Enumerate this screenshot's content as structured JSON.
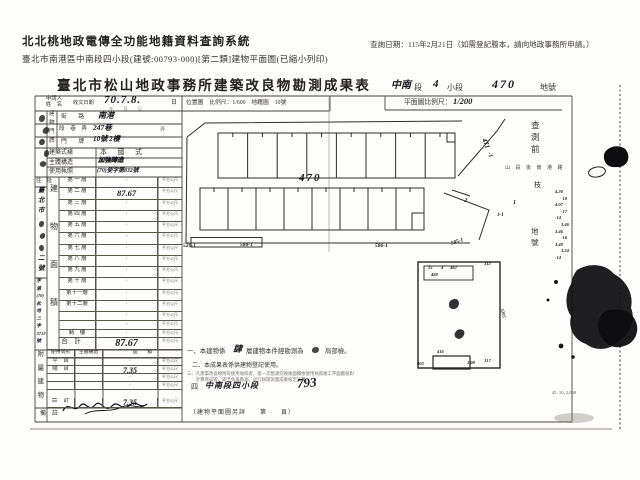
{
  "header": {
    "system_title": "北北桃地政電傳全功能地籍資料查詢系統",
    "doc_subtitle": "臺北市南港區中南段四小段(建號:00793-000)[第二類]建物平面圖(已縮小列印)",
    "query_date": "查詢日期：115年2月21日（如需登記謄本，請向地政事務所申請。）"
  },
  "form": {
    "title": "臺北市松山地政事務所建築改良物勘測成果表",
    "lot_line": [
      {
        "t": "中南",
        "hw": 1,
        "x": 391,
        "y": 81,
        "s": 10
      },
      {
        "t": "段",
        "hw": 0,
        "x": 414,
        "y": 84,
        "s": 8
      },
      {
        "t": "4",
        "hw": 1,
        "x": 433,
        "y": 79,
        "s": 11
      },
      {
        "t": "小段",
        "hw": 0,
        "x": 447,
        "y": 84,
        "s": 8
      },
      {
        "t": "470",
        "hw": 1,
        "x": 492,
        "y": 78,
        "s": 12,
        "ls": 2
      },
      {
        "t": "地號",
        "hw": 0,
        "x": 540,
        "y": 84,
        "s": 8
      }
    ],
    "row1": {
      "applicant_label": "申請人\n姓　名",
      "receipt_label": "收文日期",
      "receipt_value": "70.7.8.",
      "receipt_units": "年　月　日",
      "day_suffix": "日",
      "location_scale": "位置圖　比例尺：1/600　地籍圖　10號",
      "plan_scale_label": "平面圖比例尺：",
      "plan_scale_value": "1/200"
    },
    "premises": {
      "door_col": "建物門牌",
      "street_label": "街　　路",
      "street_value": "南港",
      "lane_label": "段　巷　弄",
      "lane_value": "247巷",
      "lane_suffix": "弄",
      "plate_label": "門　　牌",
      "plate_value": "10號 2樓",
      "style_label": "建築式樣",
      "style_value": "本　國　式",
      "structure_label": "主體構造",
      "structure_value": "加強磚造",
      "license_label": "使用執照",
      "license_value": "(70)使字第832號"
    },
    "left_strip": {
      "address_label": "住　址",
      "address_top": "臺北市",
      "address_bottom": "二號",
      "file_tokens": [
        "字",
        "第",
        "(70)",
        "松",
        "地",
        "二",
        "字",
        "3712",
        "號"
      ],
      "area_col": "建物面積",
      "attach_col": "附屬建物",
      "note_label": "備　註"
    },
    "floors": {
      "rows": [
        {
          "label": "第 一 層",
          "value": "·"
        },
        {
          "label": "第 二 層",
          "value": "87.67",
          "hw": 1
        },
        {
          "label": "第 三 層",
          "value": "·"
        },
        {
          "label": "第 四 層",
          "value": "·"
        },
        {
          "label": "第 五 層",
          "value": "·"
        },
        {
          "label": "第 六 層",
          "value": "·"
        },
        {
          "label": "第 七 層",
          "value": "·"
        },
        {
          "label": "第 八 層",
          "value": "·"
        },
        {
          "label": "第 九 層",
          "value": "·"
        },
        {
          "label": "第 十 層",
          "value": "·"
        },
        {
          "label": "第十一層",
          "value": "·"
        },
        {
          "label": "第十二層",
          "value": "·"
        },
        {
          "label": "",
          "value": "·"
        },
        {
          "label": "",
          "value": "·"
        },
        {
          "label": "騎　樓",
          "value": "·"
        }
      ],
      "unit": "平方公尺",
      "total_label": "合　計",
      "total_value": "87.67"
    },
    "attachments": {
      "header": [
        "使用情形",
        "主體構造",
        "面　　積"
      ],
      "rows": [
        {
          "use": "平　台",
          "value": "·"
        },
        {
          "use": "陽　台",
          "value": "7.35",
          "hw": 1
        },
        {
          "use": "",
          "value": "·"
        },
        {
          "use": "",
          "value": "·"
        },
        {
          "use": "合　計",
          "value": "7.35",
          "hw": 1
        }
      ],
      "unit": "平方公尺"
    },
    "notes": {
      "n1_pre": "一、本建物係",
      "n1_hw": "肆",
      "n1_mid": "層建物本件經勘測為",
      "n1_post": "局部檢。",
      "n2": "二、本成果表係供建物登記使用。",
      "n3": "三、凡建築改良物附有使用執照者，第一次勘測完竣後面積依使用執照竣工平面圖核對\n　　計算無誤者，即予免再勘測，逕行辦理測量成果核定計算。",
      "n4_pre": "四",
      "n4_hw": "中南段四小段",
      "n4_num": "793",
      "footer": "（建物平面圖另詳　　第　　頁）",
      "print_code": "45. 10. 2,000"
    }
  },
  "plan": {
    "labels": [
      {
        "t": "470",
        "x": 299,
        "y": 173,
        "s": 11,
        "hw": 1,
        "ls": 2
      },
      {
        "t": "471",
        "x": 480,
        "y": 140,
        "s": 7,
        "hw": 1,
        "r": 68
      },
      {
        "t": "-1",
        "x": 487,
        "y": 152,
        "s": 6,
        "hw": 1,
        "r": 68
      },
      {
        "t": "520-1",
        "x": 183,
        "y": 244,
        "s": 5.5,
        "hw": 1
      },
      {
        "t": "588-1",
        "x": 240,
        "y": 243,
        "s": 5.5,
        "hw": 1
      },
      {
        "t": "586-1",
        "x": 375,
        "y": 244,
        "s": 5.5,
        "hw": 1
      },
      {
        "t": "585-1",
        "x": 451,
        "y": 240,
        "s": 5.5,
        "hw": 1,
        "r": -18
      },
      {
        "t": "1",
        "x": 513,
        "y": 200,
        "s": 6,
        "hw": 1
      },
      {
        "t": "1-1",
        "x": 497,
        "y": 213,
        "s": 5,
        "hw": 1
      },
      {
        "t": "2",
        "x": 464,
        "y": 198,
        "s": 6,
        "hw": 1,
        "r": 12
      },
      {
        "t": "15",
        "x": 428,
        "y": 266,
        "s": 4.5,
        "hw": 1
      },
      {
        "t": "4",
        "x": 441,
        "y": 266,
        "s": 4.5,
        "hw": 1
      },
      {
        "t": "482",
        "x": 450,
        "y": 266,
        "s": 4.5,
        "hw": 1
      },
      {
        "t": "488",
        "x": 431,
        "y": 273,
        "s": 4.5,
        "hw": 1
      },
      {
        "t": "312",
        "x": 484,
        "y": 262,
        "s": 4.5,
        "hw": 1
      },
      {
        "t": "1205",
        "x": 498,
        "y": 311,
        "s": 4.5,
        "hw": 1,
        "r": 78
      },
      {
        "t": "416",
        "x": 437,
        "y": 350,
        "s": 4.5,
        "hw": 1
      },
      {
        "t": "403",
        "x": 417,
        "y": 362,
        "s": 4.5,
        "hw": 1
      },
      {
        "t": "1.08",
        "x": 467,
        "y": 361,
        "s": 4.5,
        "hw": 1
      },
      {
        "t": "317",
        "x": 484,
        "y": 359,
        "s": 4.5,
        "hw": 1
      }
    ],
    "margin": {
      "before_survey": "查測前",
      "small_row": "山段後南港路",
      "single_char": "枝",
      "lot_no": "地號",
      "numbers": [
        "4.20",
        "-18",
        "4.07",
        "-17",
        "-14",
        "3.46",
        "3.46",
        "-16",
        "3.48",
        "3.24",
        "-14"
      ]
    }
  }
}
